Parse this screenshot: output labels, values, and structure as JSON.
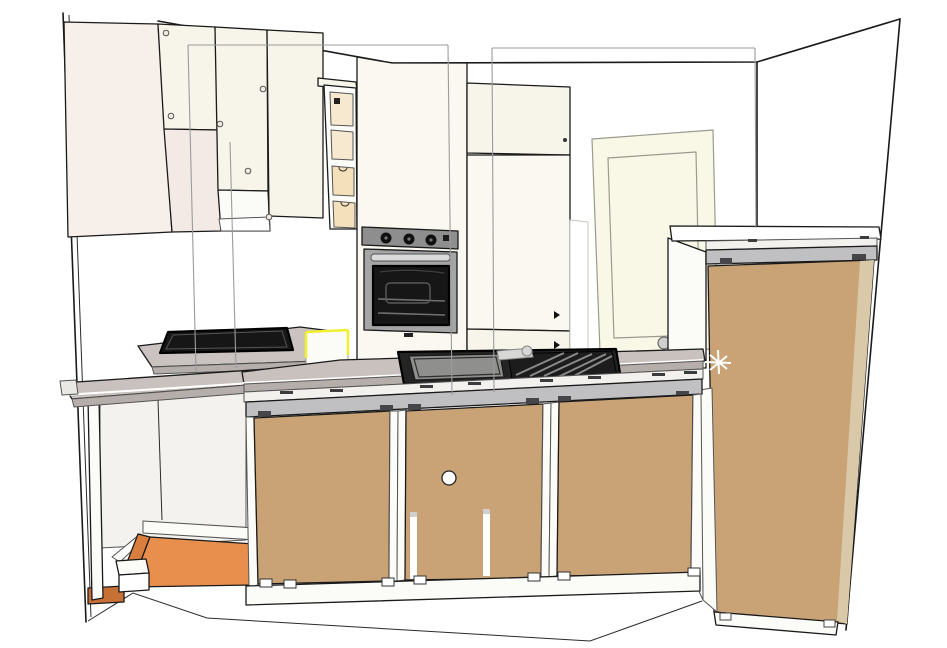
{
  "app": {
    "name": "3D kitchen model viewport",
    "view": "perspective rear elevation"
  },
  "scene": {
    "description": "3D rendering of a small kitchen: wall cabinets, built-in oven, pantry column, sink run with rear wood panels, tall cabinet, hob, open base with orange floor, selected cabinet highlighted yellow, construction guide lines",
    "objects": [
      "left wall cabinets",
      "open shelf unit with drawers",
      "oven housing column",
      "built-in oven",
      "tall pantry cabinet",
      "interior door leaning on wall",
      "tall cabinet rear view",
      "base cabinet run rear view",
      "sink with drainboard and faucet",
      "black hob",
      "gray worktops",
      "open base unit with orange floor panels",
      "selected cabinet with yellow highlight",
      "guide lines"
    ]
  },
  "colors": {
    "wall": "#ffffff",
    "cream": "#f7f4e9",
    "creamLight": "#faf8f0",
    "creamPink": "#f7efe9",
    "creamPinkDeep": "#f4eae5",
    "white": "#fbfbf8",
    "brightWhite": "#ffffff",
    "wood": "#c9a376",
    "woodEdge": "#d9c9a9",
    "counter": "#c8c1bd",
    "counterLight": "#cac3bf",
    "counterEdge": "#b5aeaa",
    "band": "#f2f1ee",
    "rail": "#c0c0c2",
    "hinge": "#46464a",
    "tick": "#3c3c3c",
    "ovenPanel": "#8e8e8e",
    "ovenFrame": "#a5a5a5",
    "ovenHandle": "#dadada",
    "glass": "#161616",
    "rack": "#707070",
    "knobBlack": "#101010",
    "knobFace": "#efebe1",
    "sinkRim": "#242424",
    "basin": "#8f8f8d",
    "drain": "#1c1c1c",
    "slat": "#8a8a88",
    "faucet": "#d7d7d5",
    "orange": "#e88f4e",
    "orangeShade": "#d97e3e",
    "orangeDeep": "#c77035",
    "yellow": "#f2ef2e",
    "doorLeaf": "#f9f8e7",
    "interior": "#f3f2ee",
    "drawerCell": "#f7e9cf",
    "drawerFace": "#f4e0ba",
    "metal": "#cfcfcd",
    "capGray": "#eae8e4"
  }
}
